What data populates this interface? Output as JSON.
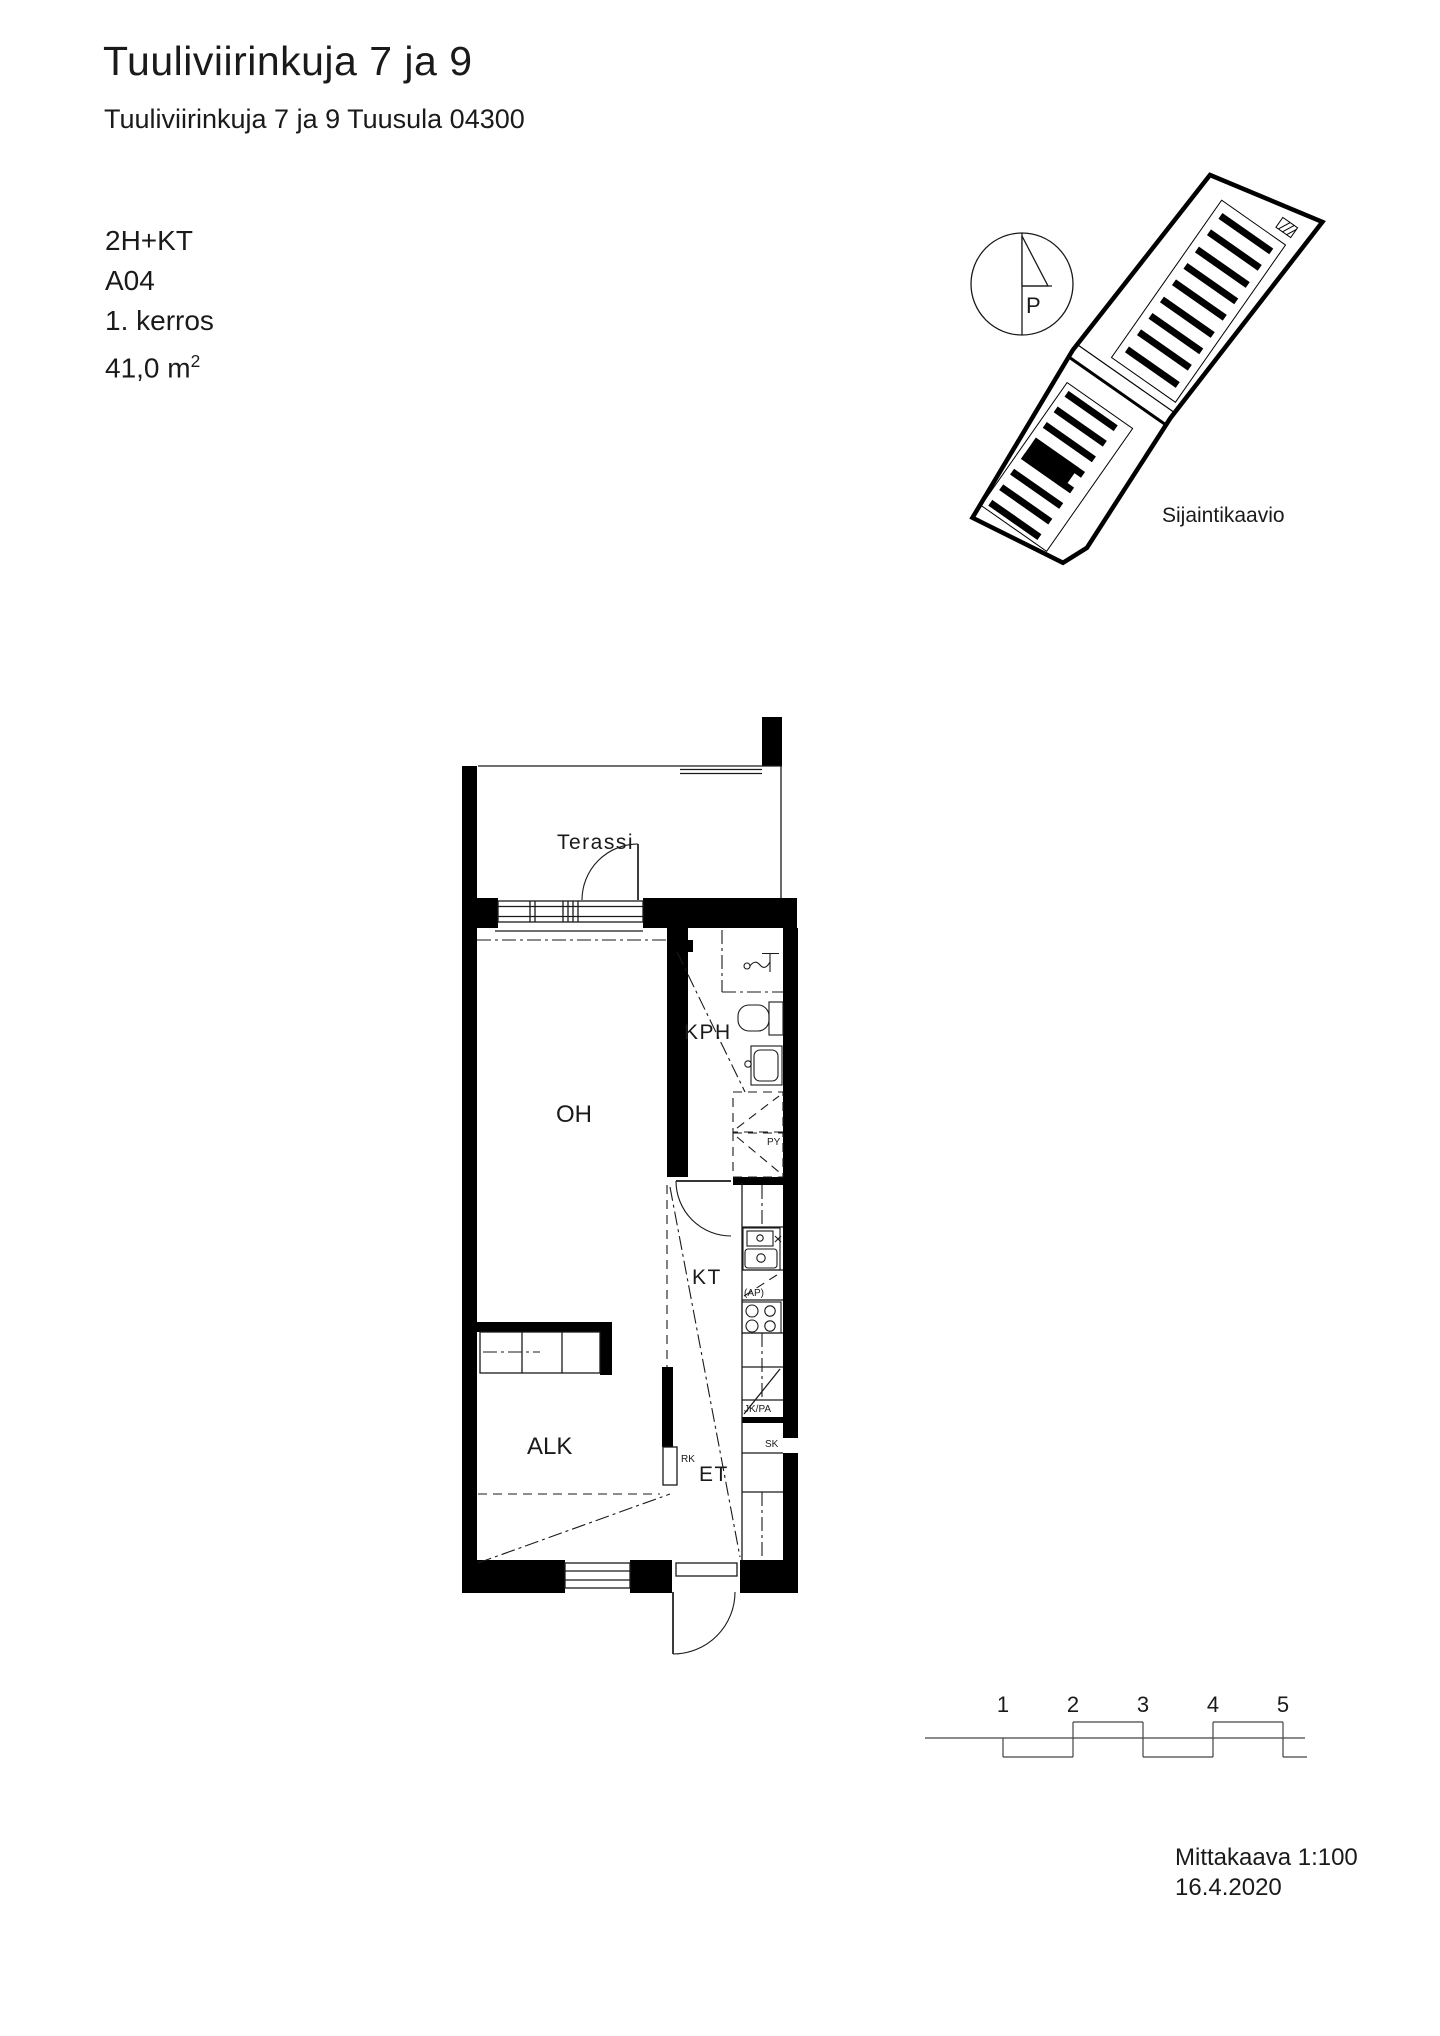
{
  "header": {
    "title": "Tuuliviirinkuja 7 ja 9",
    "subtitle": "Tuuliviirinkuja 7 ja 9 Tuusula 04300"
  },
  "info": {
    "layout": "2H+KT",
    "unit": "A04",
    "floor": "1. kerros",
    "area": "41,0 m",
    "area_sup": "2"
  },
  "site": {
    "caption": "Sijaintikaavio",
    "north": "P"
  },
  "plan": {
    "rooms": {
      "terassi": "Terassi",
      "oh": "OH",
      "kph": "KPH",
      "kt": "KT",
      "alk": "ALK",
      "et": "ET"
    },
    "labels": {
      "rk": "RK",
      "py": "PY",
      "ap": "(AP)",
      "jkpa": "JK/PA",
      "sk": "SK"
    }
  },
  "scalebar": {
    "ticks": [
      "1",
      "2",
      "3",
      "4",
      "5"
    ]
  },
  "footer": {
    "scale": "Mittakaava 1:100",
    "date": "16.4.2020"
  }
}
